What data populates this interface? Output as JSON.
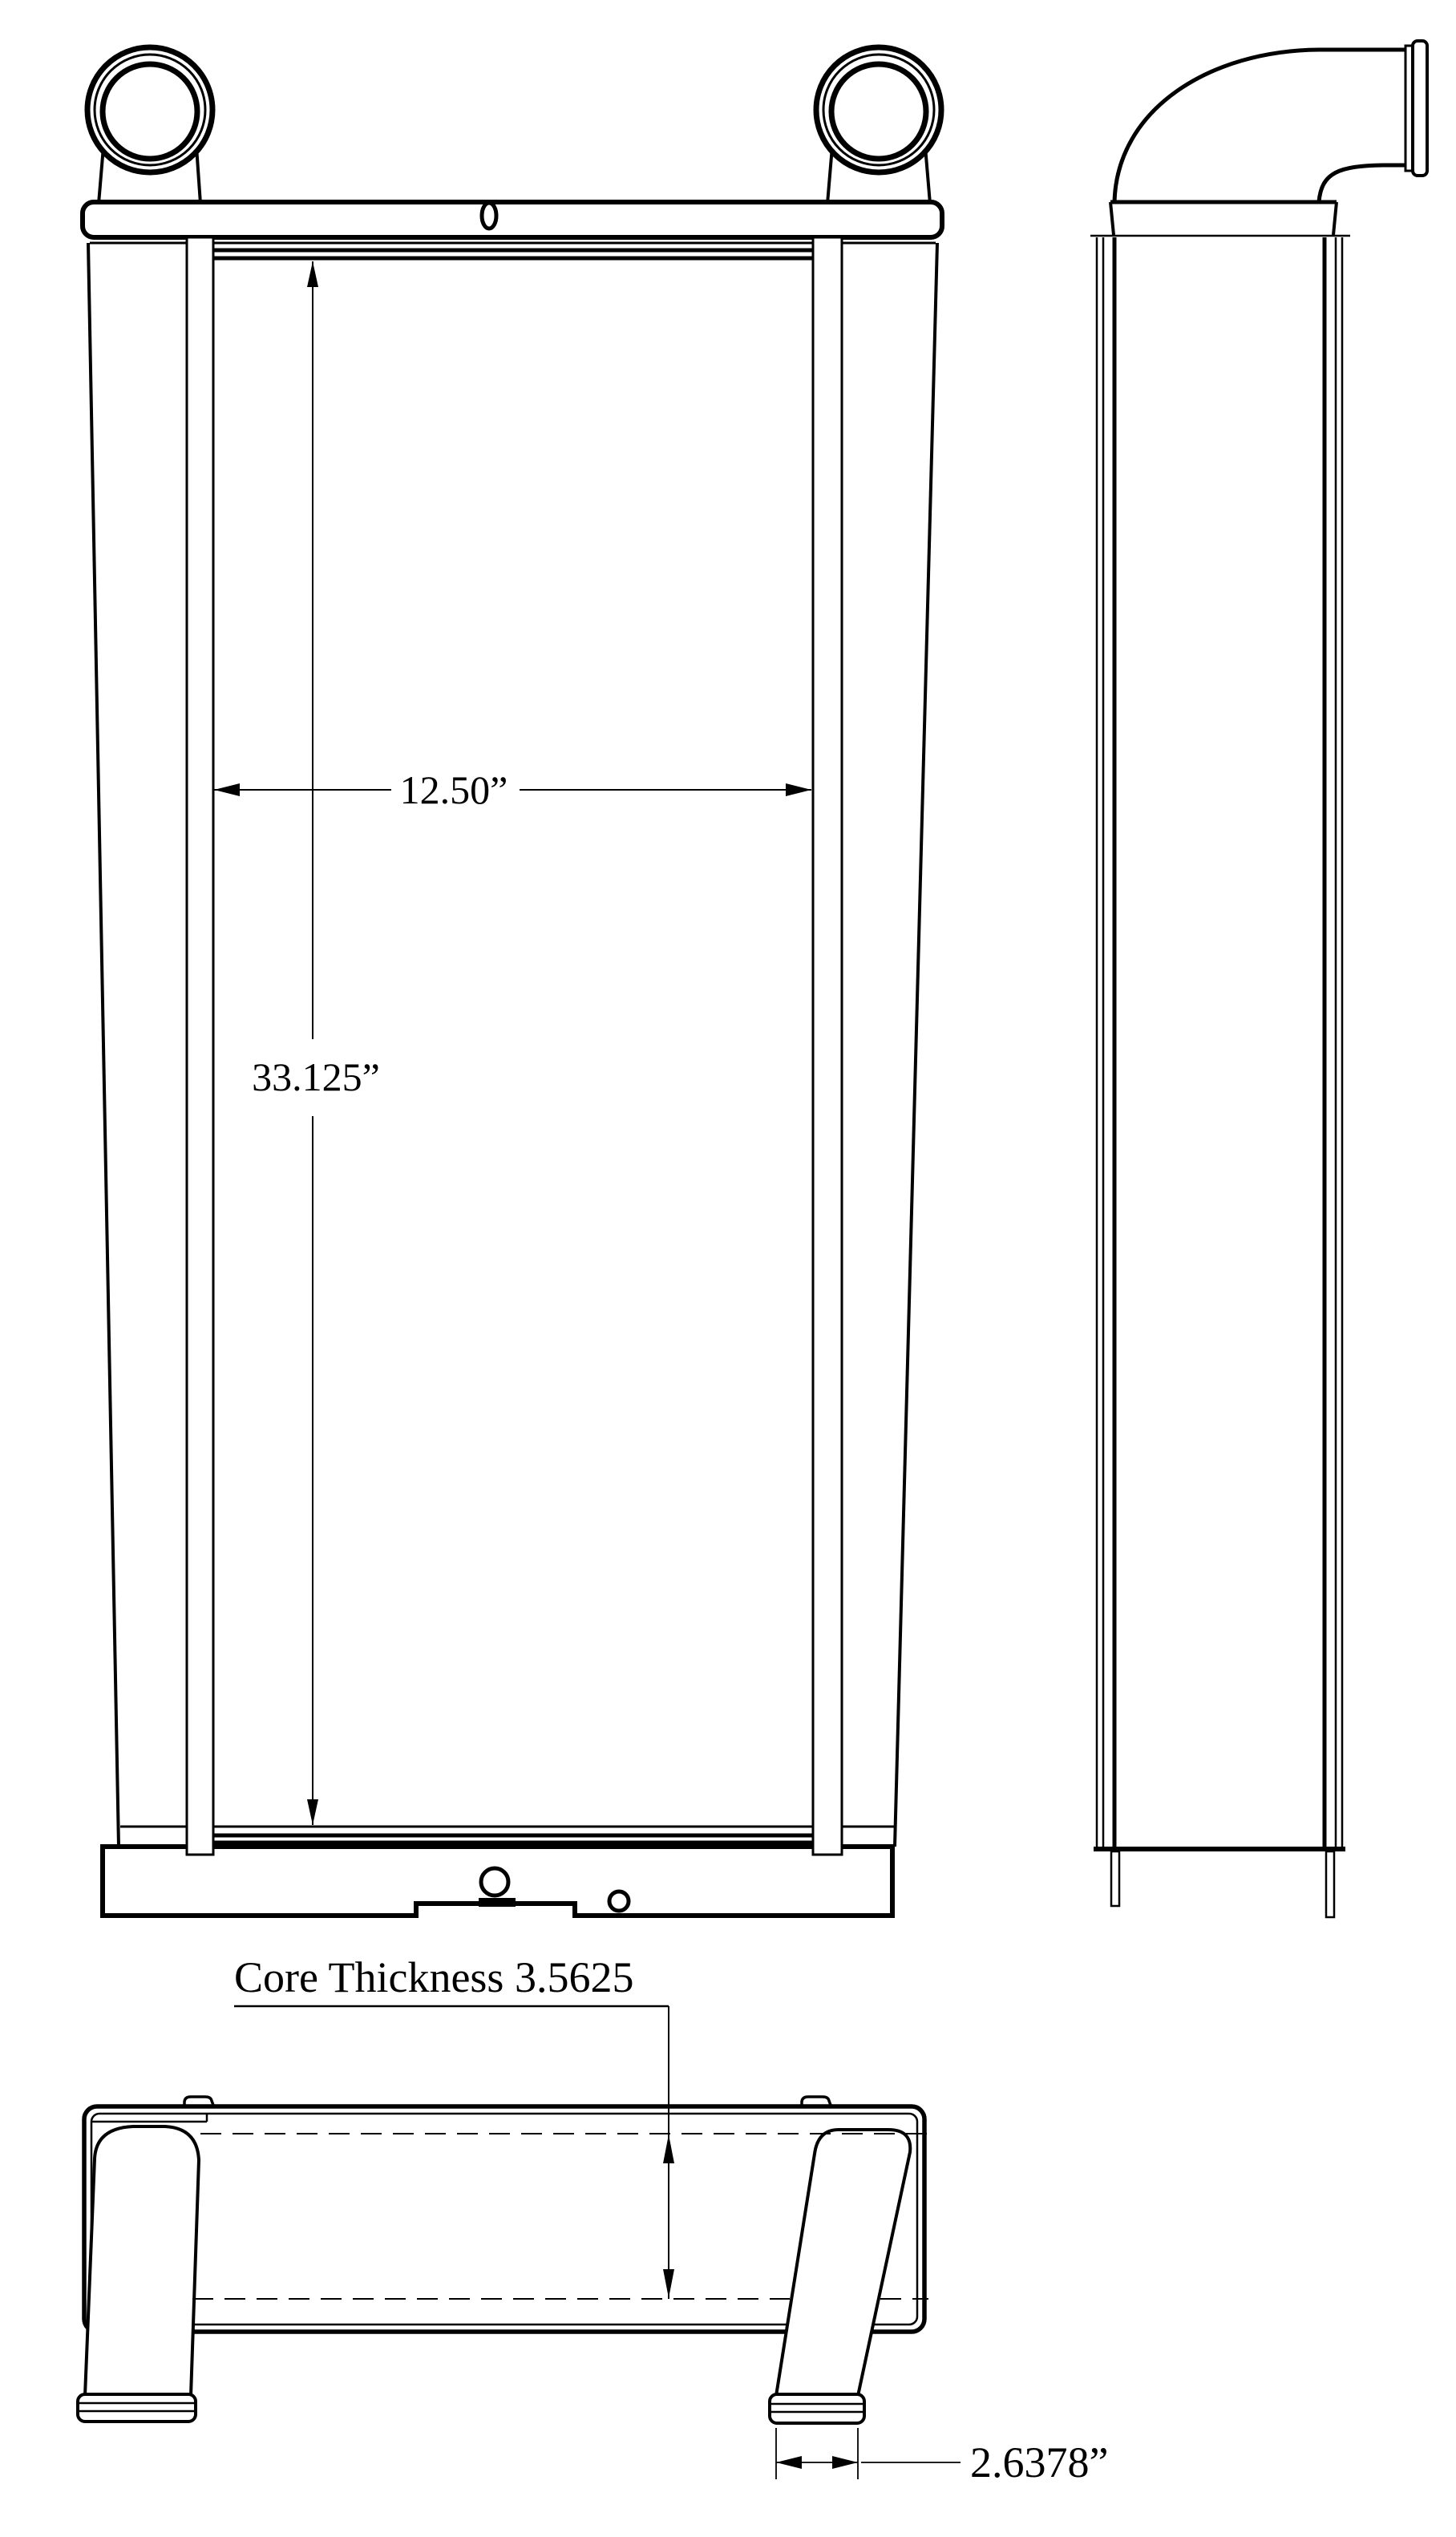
{
  "drawing": {
    "type": "engineering-orthographic-drawing",
    "subject": "charge air cooler / radiator core with inlet ports",
    "colors": {
      "background": "#ffffff",
      "line": "#000000"
    },
    "views": {
      "front": "front-view",
      "side": "side-view",
      "bottom": "bottom-view"
    },
    "dimensions": {
      "core_width_label": "12.50”",
      "core_height_label": "33.125”",
      "core_thickness_label": "Core Thickness 3.5625",
      "foot_width_label": "2.6378”"
    }
  }
}
